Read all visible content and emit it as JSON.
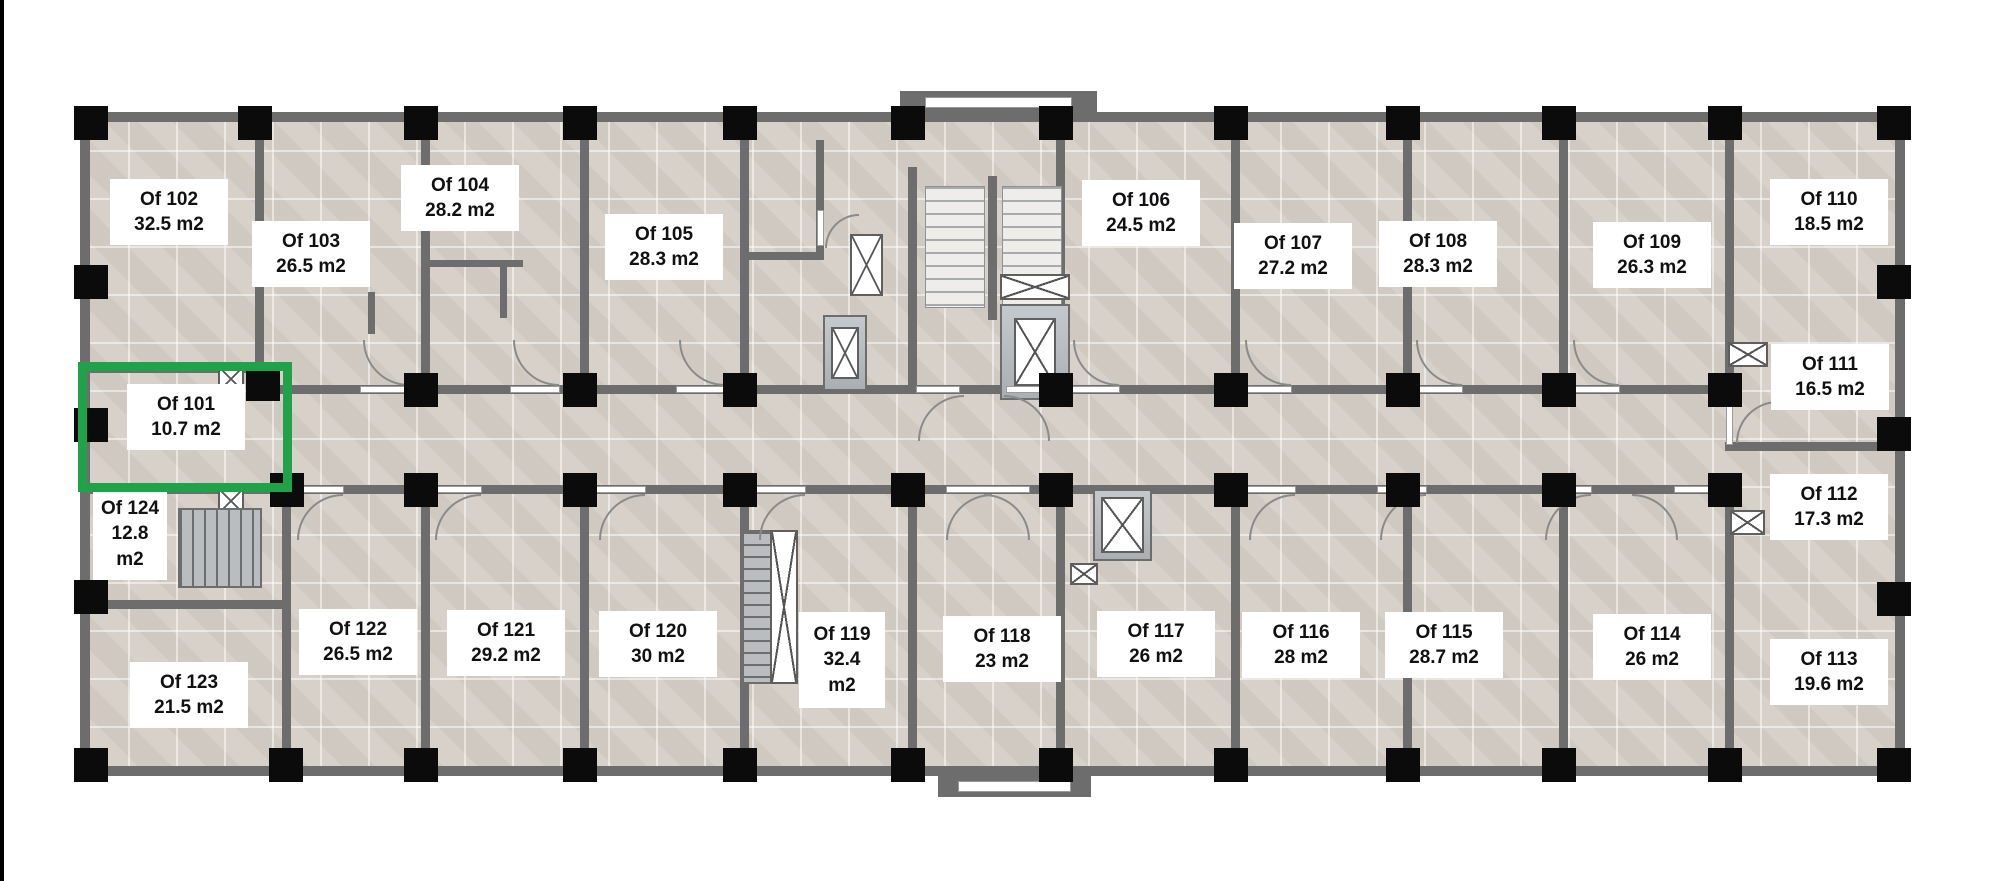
{
  "page": {
    "background": "#ffffff",
    "left_rule_color": "#000000"
  },
  "plan": {
    "colors": {
      "wall": "#6d6d6d",
      "floor": "#d6cfc7",
      "column": "#0b0b0b",
      "highlight": "#1fa24a",
      "fixture_line": "#5f5f5f",
      "elevator_fill": "#c3c9cc",
      "stair_fill": "#b9bdc0",
      "marble_fill": "#efedea"
    },
    "unit_suffix": "m2",
    "highlighted_room": "Of 101",
    "rooms": [
      {
        "id": "of-101",
        "label": "Of 101",
        "area": "10.7 m2",
        "highlighted": true
      },
      {
        "id": "of-102",
        "label": "Of 102",
        "area": "32.5 m2",
        "highlighted": false
      },
      {
        "id": "of-103",
        "label": "Of 103",
        "area": "26.5 m2",
        "highlighted": false
      },
      {
        "id": "of-104",
        "label": "Of 104",
        "area": "28.2 m2",
        "highlighted": false
      },
      {
        "id": "of-105",
        "label": "Of 105",
        "area": "28.3 m2",
        "highlighted": false
      },
      {
        "id": "of-106",
        "label": "Of 106",
        "area": "24.5 m2",
        "highlighted": false
      },
      {
        "id": "of-107",
        "label": "Of 107",
        "area": "27.2 m2",
        "highlighted": false
      },
      {
        "id": "of-108",
        "label": "Of 108",
        "area": "28.3 m2",
        "highlighted": false
      },
      {
        "id": "of-109",
        "label": "Of 109",
        "area": "26.3 m2",
        "highlighted": false
      },
      {
        "id": "of-110",
        "label": "Of 110",
        "area": "18.5 m2",
        "highlighted": false
      },
      {
        "id": "of-111",
        "label": "Of 111",
        "area": "16.5 m2",
        "highlighted": false
      },
      {
        "id": "of-112",
        "label": "Of 112",
        "area": "17.3 m2",
        "highlighted": false
      },
      {
        "id": "of-113",
        "label": "Of 113",
        "area": "19.6 m2",
        "highlighted": false
      },
      {
        "id": "of-114",
        "label": "Of 114",
        "area": "26 m2",
        "highlighted": false
      },
      {
        "id": "of-115",
        "label": "Of 115",
        "area": "28.7 m2",
        "highlighted": false
      },
      {
        "id": "of-116",
        "label": "Of 116",
        "area": "28 m2",
        "highlighted": false
      },
      {
        "id": "of-117",
        "label": "Of 117",
        "area": "26 m2",
        "highlighted": false
      },
      {
        "id": "of-118",
        "label": "Of 118",
        "area": "23 m2",
        "highlighted": false
      },
      {
        "id": "of-119",
        "label": "Of 119",
        "area": "32.4 m2",
        "highlighted": false
      },
      {
        "id": "of-120",
        "label": "Of 120",
        "area": "30 m2",
        "highlighted": false
      },
      {
        "id": "of-121",
        "label": "Of 121",
        "area": "29.2 m2",
        "highlighted": false
      },
      {
        "id": "of-122",
        "label": "Of 122",
        "area": "26.5 m2",
        "highlighted": false
      },
      {
        "id": "of-123",
        "label": "Of 123",
        "area": "21.5 m2",
        "highlighted": false
      },
      {
        "id": "of-124",
        "label": "Of 124",
        "area": "12.8 m2",
        "highlighted": false
      }
    ]
  }
}
